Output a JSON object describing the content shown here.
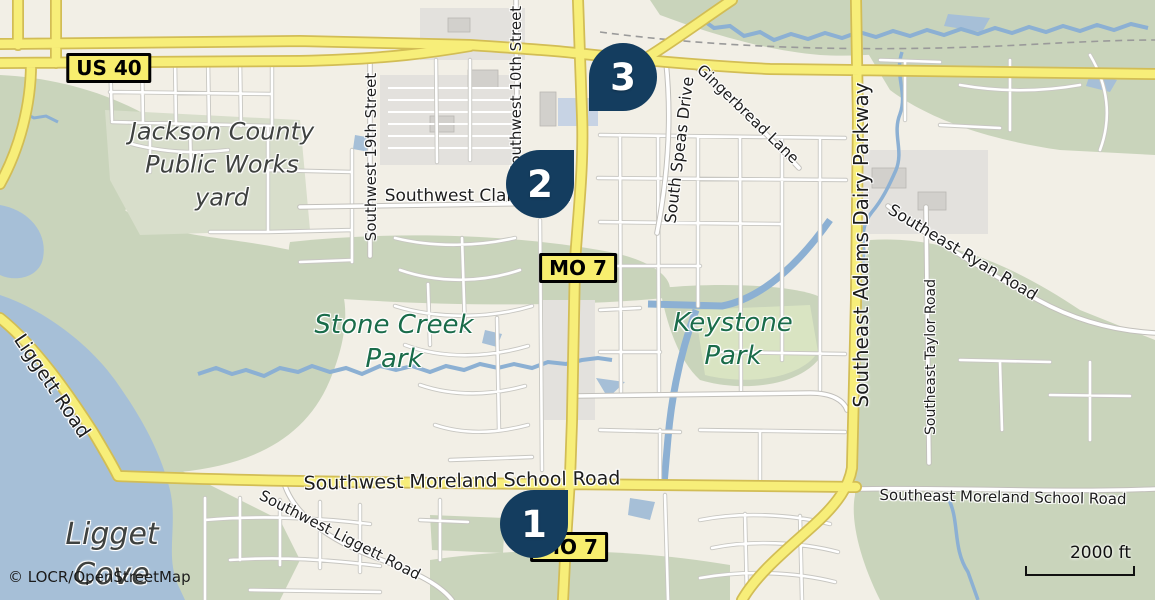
{
  "map": {
    "copyright": "© LOCR/OpenStreetMap",
    "scale_label": "2000 ft",
    "colors": {
      "land": "#f2efe6",
      "woodland": "#c9d4bb",
      "urban_gray": "#e3e1dd",
      "water": "#a6bfd7",
      "creek": "#8cb0d3",
      "road_yellow": "#f7ee79",
      "road_yellow_casing": "#d2bd55",
      "road_white": "#ffffff",
      "road_white_casing": "#c9c7c2",
      "marker_navy": "#143d5f",
      "shield_yellow": "#f8ee6e",
      "park_text_green": "#1a6c4a",
      "place_text_gray": "#3f4240"
    },
    "shields": [
      {
        "id": "us40",
        "label": "US 40",
        "x": 109,
        "y": 68
      },
      {
        "id": "mo7-north",
        "label": "MO 7",
        "x": 578,
        "y": 268
      },
      {
        "id": "mo7-south",
        "label": "MO 7",
        "x": 569,
        "y": 547
      }
    ],
    "markers": [
      {
        "number": "1",
        "cx": 534,
        "cy": 524,
        "tip": "ne"
      },
      {
        "number": "2",
        "cx": 540,
        "cy": 184,
        "tip": "ne"
      },
      {
        "number": "3",
        "cx": 623,
        "cy": 77,
        "tip": "sw"
      }
    ],
    "area_labels": [
      {
        "id": "jackson-county-public-works-yard",
        "type": "place",
        "lines": [
          "Jackson County",
          "Public Works",
          "yard"
        ],
        "x": 222,
        "y": 165,
        "size": 24,
        "line_height": 33
      },
      {
        "id": "stone-creek-park",
        "type": "park",
        "lines": [
          "Stone Creek",
          "Park"
        ],
        "x": 394,
        "y": 342,
        "size": 26,
        "line_height": 34
      },
      {
        "id": "keystone-park",
        "type": "park",
        "lines": [
          "Keystone",
          "Park"
        ],
        "x": 733,
        "y": 340,
        "size": 26,
        "line_height": 33
      },
      {
        "id": "ligget-cove",
        "type": "place",
        "lines": [
          "Ligget",
          "Cove"
        ],
        "x": 112,
        "y": 555,
        "size": 30,
        "line_height": 40
      }
    ],
    "street_labels": [
      {
        "text": "Southwest 10th Street",
        "x": 516,
        "y": 90,
        "rotate": -90,
        "size": 15
      },
      {
        "text": "Southwest 19th Street",
        "x": 371,
        "y": 157,
        "rotate": -90,
        "size": 15
      },
      {
        "text": "Southwest Clark Road",
        "x": 478,
        "y": 196,
        "rotate": 0,
        "size": 17
      },
      {
        "text": "South Speas Drive",
        "x": 679,
        "y": 150,
        "rotate": -83,
        "size": 16
      },
      {
        "text": "Gingerbread Lane",
        "x": 748,
        "y": 114,
        "rotate": 44,
        "size": 15
      },
      {
        "text": "Southeast Adams Dairy Parkway",
        "x": 861,
        "y": 245,
        "rotate": -90,
        "size": 20
      },
      {
        "text": "Southeast Ryan Road",
        "x": 963,
        "y": 252,
        "rotate": 31,
        "size": 16
      },
      {
        "text": "Southeast Taylor Road",
        "x": 931,
        "y": 357,
        "rotate": -90,
        "size": 14
      },
      {
        "text": "Southwest Moreland School Road",
        "x": 462,
        "y": 481,
        "rotate": -1,
        "size": 19
      },
      {
        "text": "Southeast Moreland School Road",
        "x": 1003,
        "y": 497,
        "rotate": 1,
        "size": 15
      },
      {
        "text": "Southwest Liggett Road",
        "x": 340,
        "y": 535,
        "rotate": 27,
        "size": 15
      },
      {
        "text": "Liggett Road",
        "x": 52,
        "y": 386,
        "rotate": 56,
        "size": 19
      }
    ]
  }
}
